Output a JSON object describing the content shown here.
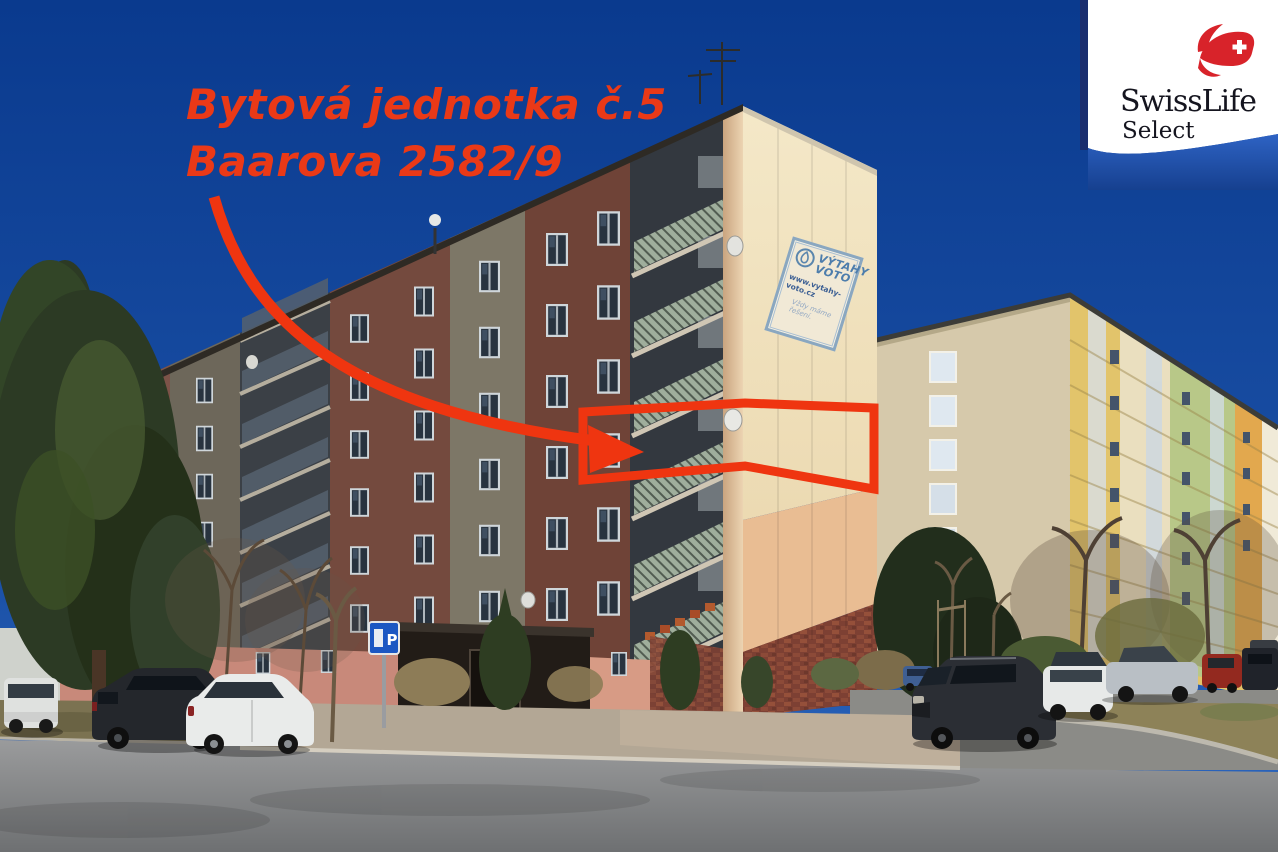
{
  "annotation": {
    "line1": "Bytová jednotka č.5",
    "line2": "Baarova 2582/9"
  },
  "corner_logo": {
    "brand": "SwissLife",
    "product": "Select"
  },
  "building_banner": {
    "company_line1": "VÝTAHY",
    "company_line2": "VOTO",
    "website": "www.vytahy-voto.cz",
    "slogan": "Vždy máme řešení."
  },
  "street_sign": {
    "letter": "P"
  },
  "icons": {
    "corner_logo_mark": "swiss-flag-icon",
    "banner_mark": "voto-drop-icon",
    "parking": "parking-sign-icon",
    "satellite": "satellite-dish-icon",
    "highlight": "red-arrow-icon"
  },
  "colors": {
    "annotation_red": "#ea3917",
    "sky_top": "#0a3a8e",
    "sky_bottom": "#2f6ac2",
    "gable_cream": "#f2e5c3",
    "gable_peach": "#e9bd93",
    "facade_shadow_brown": "#6f4a3e",
    "brick_red": "#7d4033",
    "banner_blue": "#4d7dac",
    "logo_red": "#d8232a",
    "logo_navy": "#1b2e6e"
  }
}
